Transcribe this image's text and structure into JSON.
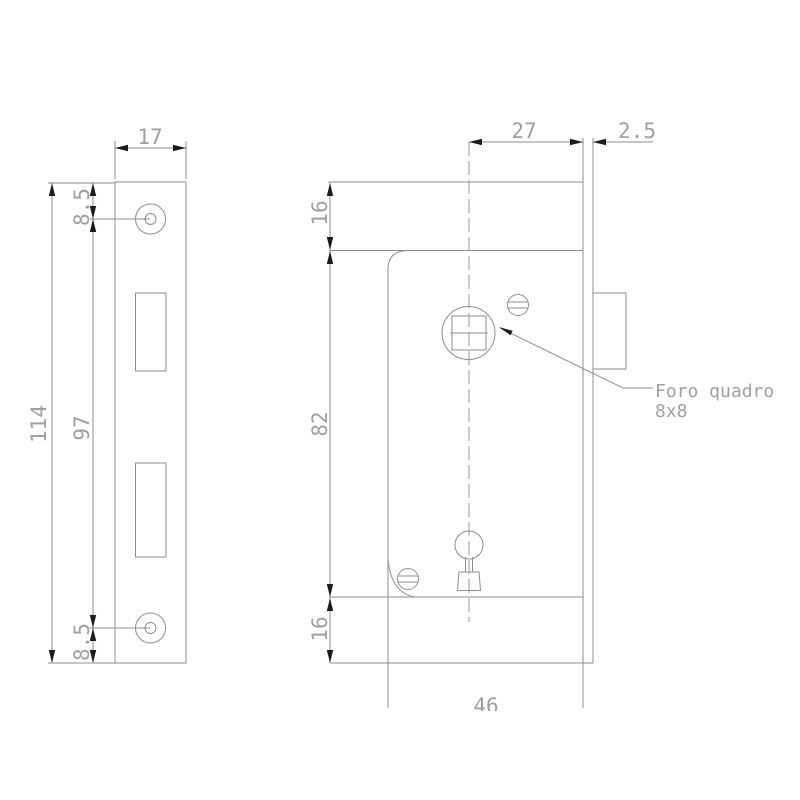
{
  "colors": {
    "line_gray": "#8e8e8e",
    "text_gray": "#9f9f9f",
    "arrow_black": "#1c1c1c",
    "background": "#ffffff"
  },
  "front_view": {
    "width": "17",
    "top_hole_offset": "8.5",
    "total_height": "114",
    "hole_spacing": "97",
    "bottom_hole_offset": "8.5"
  },
  "side_view": {
    "backset": "27",
    "faceplate_thickness": "2.5",
    "top_margin": "16",
    "case_height": "82",
    "bottom_margin": "16",
    "case_depth": "46",
    "square_hole_note_line1": "Foro quadro",
    "square_hole_note_line2": "8x8"
  }
}
